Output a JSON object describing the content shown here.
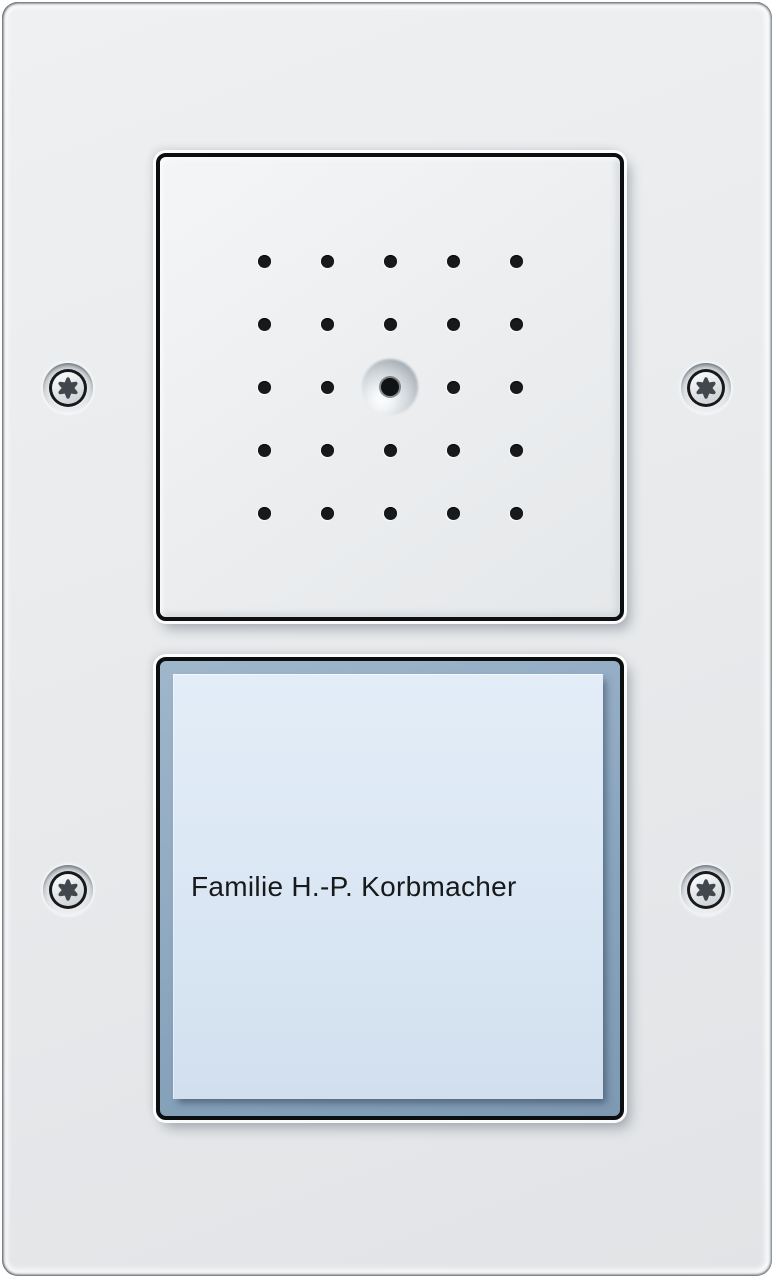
{
  "device": {
    "kind": "door-intercom-panel",
    "modules": [
      "speaker",
      "call-button"
    ]
  },
  "nameplate": {
    "label": "Familie H.-P. Korbmacher"
  },
  "speaker": {
    "grid_rows": 5,
    "grid_cols": 5,
    "hole_count": 25,
    "center_feature": "microphone-dome"
  },
  "screws": {
    "count": 4,
    "type": "torx",
    "positions": [
      "top-left",
      "top-right",
      "bottom-left",
      "bottom-right"
    ]
  },
  "colors": {
    "plate": "#e8eaec",
    "module_border": "#0c0e10",
    "button_frame": "#8aa6bf",
    "nameplate_bg": "#d9e5f2",
    "label_text": "#17191b",
    "speaker_hole": "#17191b",
    "screw_metal": "#d7dadd"
  }
}
